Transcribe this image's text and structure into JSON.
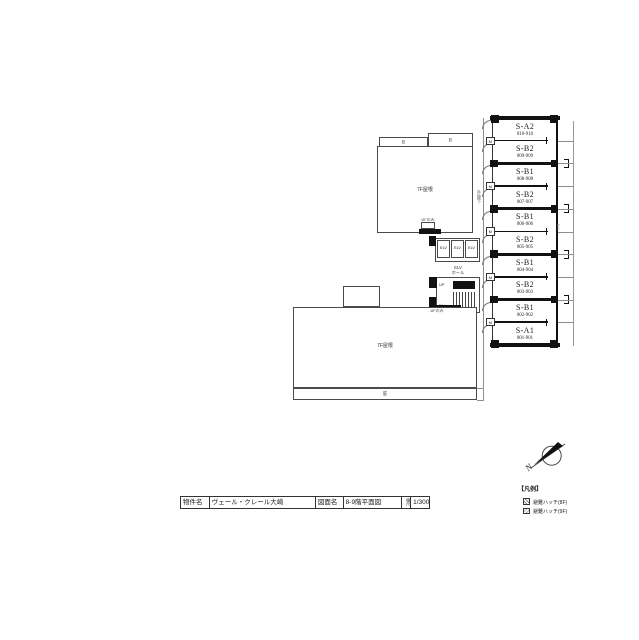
{
  "sheet": {
    "background": "#ffffff",
    "line_color": "#4a4a4a"
  },
  "title_block": {
    "property_label": "物件名",
    "property_value": "ヴェール・クレール大崎",
    "drawing_label": "図面名",
    "drawing_value": "8-9階平面図",
    "scale_label": "縮尺",
    "scale_value": "1/300"
  },
  "legend": {
    "title": "【凡例】",
    "items": [
      {
        "symbol": "hatch-8f",
        "label": "避難ハッチ(8F)"
      },
      {
        "symbol": "hatch-9f",
        "label": "避難ハッチ(9F)"
      }
    ]
  },
  "compass": {
    "north_label": "N"
  },
  "plan": {
    "upper_roof_label": "7F屋根",
    "lower_roof_label": "7F屋根",
    "canopy_tab1": "庇",
    "canopy_tab2": "庇",
    "canopy_strip": "庇",
    "note_upper": "↓8Fのみ",
    "note_lower": "↓8Fのみ",
    "corridor_label": "外廊下",
    "elevator_label": "ELV",
    "elevator_hall_line1": "ELV",
    "elevator_hall_line2": "ホール",
    "stair_up_label": "UP",
    "stair_dn_label": "DN",
    "meter_box_label": "M",
    "dim_note": "8.5",
    "units": [
      {
        "type": "S-A2",
        "numbers": "810-910"
      },
      {
        "type": "S-B2",
        "numbers": "809-909"
      },
      {
        "type": "S-B1",
        "numbers": "808-908"
      },
      {
        "type": "S-B2",
        "numbers": "807-907"
      },
      {
        "type": "S-B1",
        "numbers": "806-906"
      },
      {
        "type": "S-B2",
        "numbers": "805-905"
      },
      {
        "type": "S-B1",
        "numbers": "804-904"
      },
      {
        "type": "S-B2",
        "numbers": "803-903"
      },
      {
        "type": "S-B1",
        "numbers": "802-902"
      },
      {
        "type": "S-A1",
        "numbers": "801-901"
      }
    ]
  }
}
